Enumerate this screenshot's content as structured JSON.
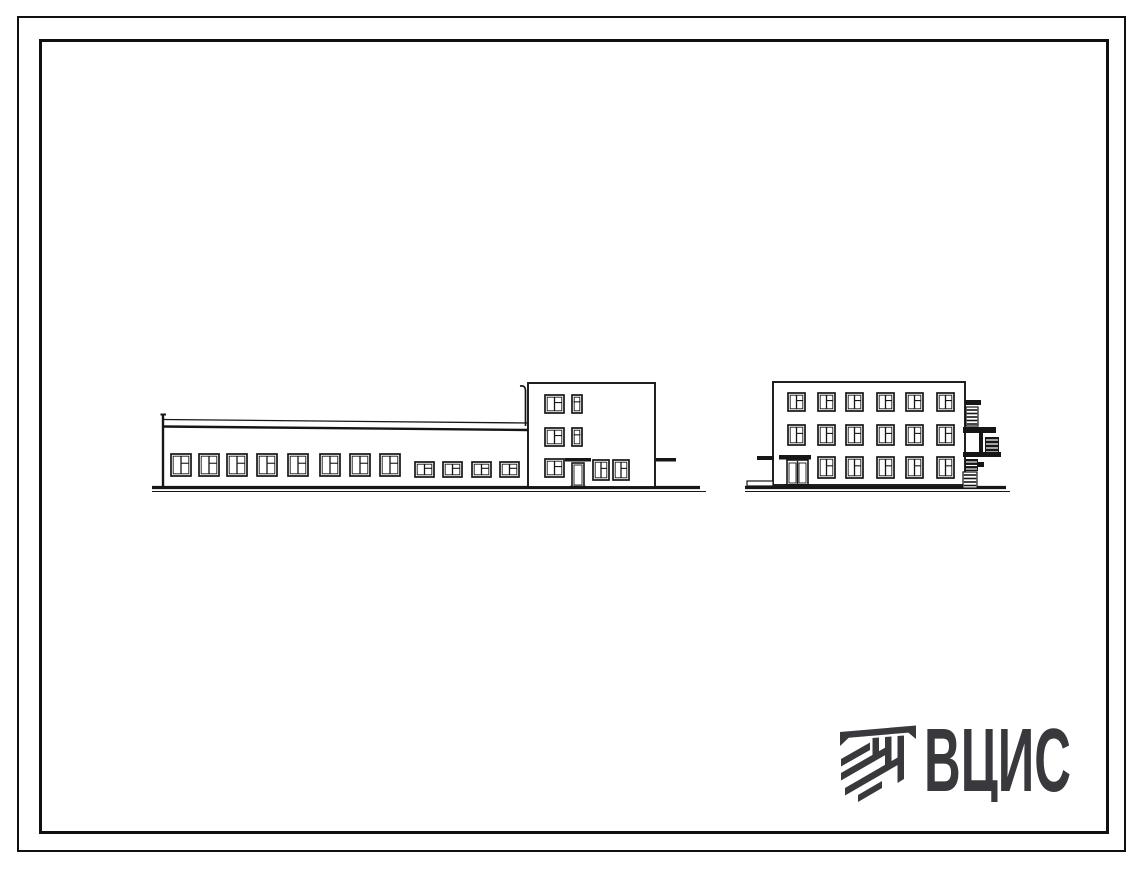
{
  "sheet": {
    "background": "#ffffff",
    "frame_color": "#101010"
  },
  "logo": {
    "text": "ВЦИС",
    "color": "#38383d",
    "emblem": "vcis-emblem"
  },
  "drawing": {
    "stroke_color": "#161616",
    "left_elevation": {
      "label": "long-building-side-elevation",
      "ground": {
        "x1": 152,
        "x2": 700,
        "y": 487.5
      },
      "wing": {
        "x1": 163,
        "x2": 528,
        "top1": 419.5,
        "top1b": 423,
        "top2": 426.5,
        "top2b": 430,
        "base": 487,
        "parapet_top": 414
      },
      "pipe": {
        "x": 525.5,
        "top": 386,
        "bottom": 426
      },
      "tall_windows": {
        "y": 454,
        "w": 20,
        "h": 22,
        "xs": [
          171,
          199,
          227,
          257,
          288,
          320,
          350,
          380
        ]
      },
      "small_windows": {
        "y": 462,
        "w": 19,
        "h": 15,
        "xs": [
          415,
          443,
          472,
          500
        ]
      },
      "block": {
        "x1": 528,
        "x2": 655,
        "top": 383,
        "base": 487
      },
      "block_square_windows": {
        "x": 545,
        "w": 19,
        "h": 18,
        "ys": [
          395,
          428,
          459
        ]
      },
      "block_narrow_windows": {
        "x": 572,
        "w": 10,
        "h": 18,
        "ys": [
          395,
          428
        ]
      },
      "block_lower_pair": {
        "y": 460,
        "w": 16,
        "h": 20,
        "xs": [
          593,
          613
        ]
      },
      "door": {
        "x": 572,
        "y": 463,
        "w": 12,
        "h": 24
      },
      "canopy": {
        "x": 565,
        "y": 458,
        "w": 26,
        "h": 3.5
      },
      "right_ledge": {
        "x": 656,
        "y": 458,
        "w": 20,
        "h": 3.5
      }
    },
    "right_elevation": {
      "label": "three-storey-end-elevation",
      "ground": {
        "x1": 745,
        "x2": 1006,
        "y": 487.5
      },
      "body": {
        "x1": 773,
        "x2": 965,
        "top": 382,
        "base": 485
      },
      "window_w": 17,
      "cols": [
        788,
        818,
        846,
        877,
        906,
        937
      ],
      "rows": [
        {
          "y": 393,
          "h": 18,
          "cols": [
            0,
            1,
            2,
            3,
            4,
            5
          ]
        },
        {
          "y": 425,
          "h": 20,
          "cols": [
            0,
            1,
            2,
            3,
            4,
            5
          ]
        },
        {
          "y": 457,
          "h": 21,
          "cols": [
            1,
            2,
            3,
            4,
            5
          ]
        }
      ],
      "door": {
        "x": 787,
        "y": 460,
        "w": 21,
        "h": 25
      },
      "canopy": {
        "x": 779,
        "y": 455,
        "w": 32,
        "h": 4.5
      },
      "left_ledge": {
        "x": 757,
        "y": 456,
        "w": 17,
        "h": 4
      },
      "step": {
        "x": 747,
        "y": 481,
        "w": 26,
        "h": 5
      },
      "fire_escape": {
        "cap": {
          "x": 965,
          "y": 400,
          "w": 16,
          "h": 5
        },
        "ladder_top": {
          "x": 966,
          "y": 407,
          "w": 12,
          "h": 19
        },
        "platform1": {
          "x": 963,
          "y": 427,
          "w": 33,
          "h": 6
        },
        "post": {
          "x": 979,
          "y": 433,
          "w": 4,
          "h": 20
        },
        "console": {
          "x": 985,
          "y": 437,
          "w": 14,
          "h": 17
        },
        "platform2": {
          "x": 963,
          "y": 452,
          "w": 38,
          "h": 5
        },
        "block": {
          "x": 965,
          "y": 459,
          "w": 13,
          "h": 12
        },
        "bracket": {
          "x": 978,
          "y": 462,
          "w": 6,
          "h": 5
        },
        "ladder_bottom": {
          "x": 963,
          "y": 472,
          "w": 14,
          "h": 16
        }
      }
    }
  }
}
